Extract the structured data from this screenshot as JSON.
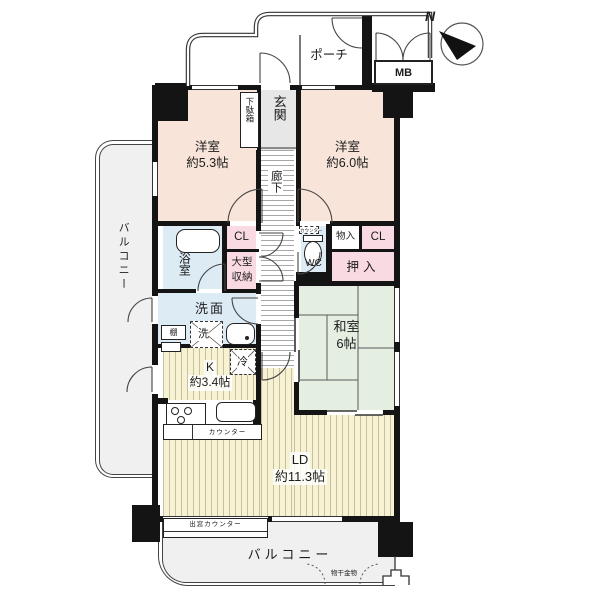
{
  "compass": {
    "north": "N"
  },
  "outdoor": {
    "porch": {
      "label": "ポーチ"
    },
    "meter_box": {
      "label": "MB"
    },
    "balcony_left": {
      "label": "バルコニー"
    },
    "balcony_bottom": {
      "label": "バルコニー"
    },
    "laundry_fitting": {
      "label": "物干金物"
    },
    "bay_window_counter": {
      "label": "出窓カウンター"
    }
  },
  "entry": {
    "genkan": {
      "label": "玄関"
    },
    "shoe_box": {
      "label": "下駄箱"
    },
    "hallway": {
      "label": "廊下"
    }
  },
  "rooms": {
    "western_5_3": {
      "name": "洋室",
      "size": "約5.3帖"
    },
    "western_6_0": {
      "name": "洋室",
      "size": "約6.0帖"
    },
    "japanese_6": {
      "name": "和室",
      "size": "6帖"
    },
    "kitchen": {
      "name": "K",
      "size": "約3.4帖"
    },
    "living_dining": {
      "name": "LD",
      "size": "約11.3帖"
    },
    "bathroom": {
      "label": "浴室"
    },
    "washroom": {
      "label": "洗面"
    },
    "toilet": {
      "label": "WC"
    }
  },
  "storage": {
    "closet_west": {
      "label": "CL"
    },
    "large_storage": {
      "label": "大型収納"
    },
    "storage_east": {
      "label": "物入"
    },
    "closet_east": {
      "label": "CL"
    },
    "oshiire": {
      "label": "押入"
    },
    "shelf": {
      "label": "棚"
    }
  },
  "fixtures": {
    "washing_machine": {
      "label": "洗"
    },
    "refrigerator": {
      "label": "冷"
    },
    "kitchen_counter": {
      "label": "カウンター"
    },
    "wc_counter": {
      "label": "カウンター"
    }
  },
  "colors": {
    "western_room": "#f8e4d9",
    "closet": "#f9dae3",
    "tatami": "#e4efe2",
    "water_area": "#dcebf4",
    "flooring": "#f7f2d3",
    "balcony": "#f0f0f0",
    "wall": "#141414"
  }
}
